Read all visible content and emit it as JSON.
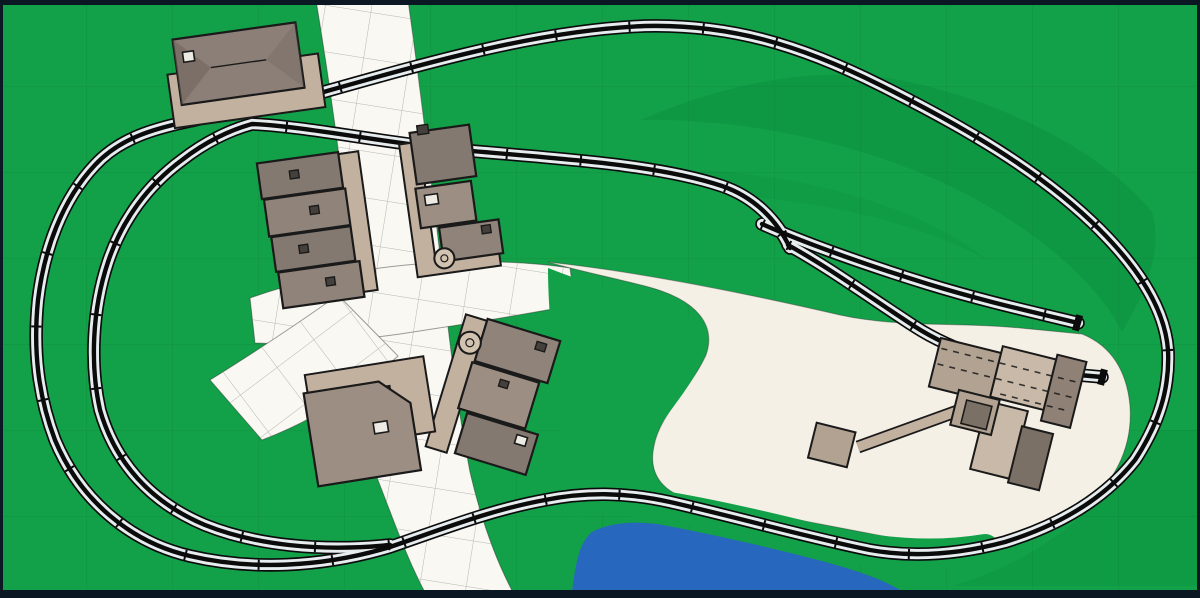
{
  "scene": {
    "kind": "model-railroad-track-plan",
    "areas": [
      "grass-field",
      "north-south-road",
      "town-plaza",
      "southwest-road",
      "gravel-yard",
      "pond"
    ],
    "tracks": [
      "outer-main-loop",
      "inner-branch-line",
      "industry-siding-upper",
      "industry-siding-lower"
    ],
    "buildings": [
      "station-with-platform",
      "row-houses-west",
      "shops-east",
      "shops-south",
      "warehouse",
      "industrial-plant",
      "conveyor-with-hopper"
    ],
    "details": [
      "storage-tank-east",
      "storage-tank-south",
      "chimneys",
      "track-joints",
      "grade-crossings"
    ]
  },
  "colors": {
    "frame": "#0B1722",
    "grass": "#12A148",
    "grass_dark": "#006B2D",
    "grass_grid": "#063D1C",
    "track_bed": "#E7EDEE",
    "track_rail": "#0B0B0C",
    "road": "#F9F8F3",
    "road_line": "#A9ACA7",
    "yard": "#F4F0E6",
    "pond": "#2767BE",
    "tan": "#C3B1A0",
    "tan_light": "#D2C2B0",
    "bldg_1": "#847970",
    "bldg_2": "#8F837A",
    "bldg_3": "#9C8E82",
    "bldg_4": "#7B7066",
    "roof_station": "#8C7F77",
    "roof_shade": "#6E635B",
    "ind_light": "#C8B9A8",
    "ind_mid": "#B2A292",
    "ind_dark": "#8F8176",
    "outline": "#1A1A1A",
    "chimney": "#45403B"
  }
}
